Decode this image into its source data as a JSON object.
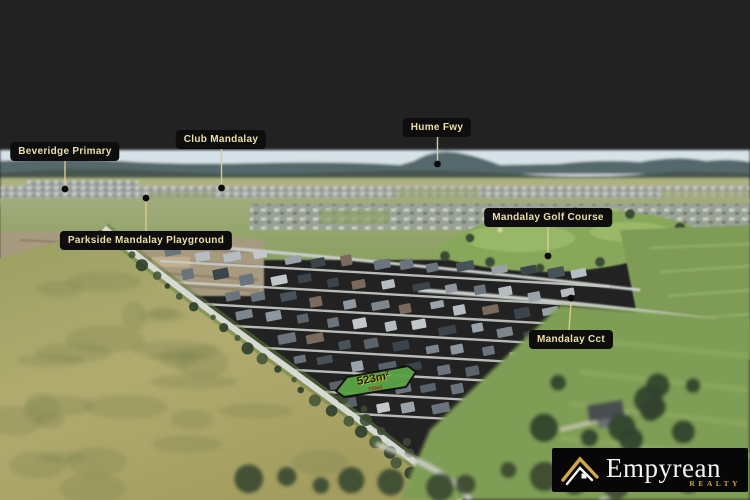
{
  "map_labels": [
    {
      "id": "beveridge-primary",
      "text": "Beveridge Primary"
    },
    {
      "id": "club-mandalay",
      "text": "Club Mandalay"
    },
    {
      "id": "hume-fwy",
      "text": "Hume Fwy"
    },
    {
      "id": "mandalay-golf-course",
      "text": "Mandalay Golf Course"
    },
    {
      "id": "parkside-mandalay-playground",
      "text": "Parkside Mandalay Playground"
    },
    {
      "id": "mandalay-cct",
      "text": "Mandalay Cct"
    }
  ],
  "lot": {
    "area_label": "523m²",
    "status_label": "Titled"
  },
  "logo": {
    "brand": "Empyrean",
    "tagline": "REALTY"
  },
  "colors": {
    "label_bg": "#0d0d0d",
    "label_text": "#ecdfa9",
    "leader_line": "#dcca8c",
    "pin_dot": "#0b0b0b",
    "lot_fill": "#5ba345",
    "lot_border": "#101010",
    "lot_area_text": "#201d06",
    "lot_status_text": "#b3251c",
    "logo_bg": "#070707",
    "logo_gold": "#cda54e"
  }
}
